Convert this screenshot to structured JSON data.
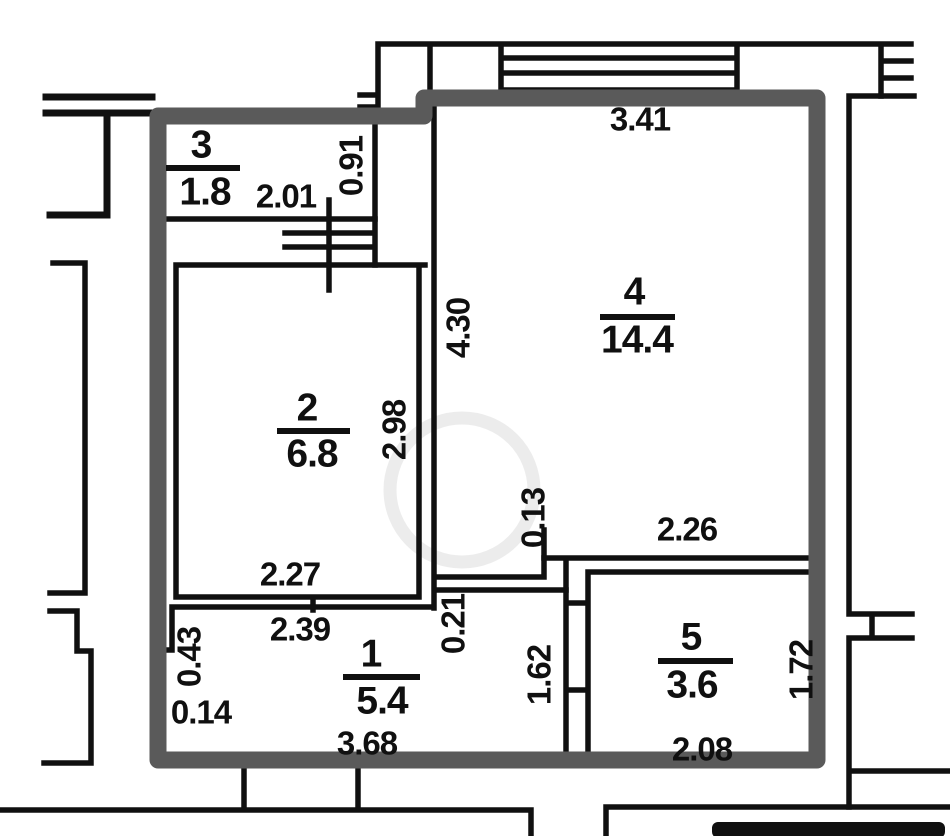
{
  "drawing": {
    "type": "apartment-floor-plan",
    "wall_color": "#5a5a5a",
    "line_color": "#101010",
    "watermark_color": "#dcdcdc",
    "rooms": [
      {
        "number": "1",
        "area": "5.4"
      },
      {
        "number": "2",
        "area": "6.8"
      },
      {
        "number": "3",
        "area": "1.8"
      },
      {
        "number": "4",
        "area": "14.4"
      },
      {
        "number": "5",
        "area": "3.6"
      }
    ],
    "dimensions": {
      "room4_width_top": "3.41",
      "room3_width": "2.01",
      "room3_height": "0.91",
      "room4_height": "4.30",
      "room2_height": "2.98",
      "room2_width": "2.27",
      "step_room4_room5": "0.13",
      "room5_width_top": "2.26",
      "hall_width_top": "2.39",
      "hall_left_step_v": "0.43",
      "hall_left_step_h": "0.14",
      "hall_nook": "0.21",
      "hall_right_height": "1.62",
      "hall_width_bottom": "3.68",
      "room5_width_bottom": "2.08",
      "room5_height": "1.72"
    }
  }
}
